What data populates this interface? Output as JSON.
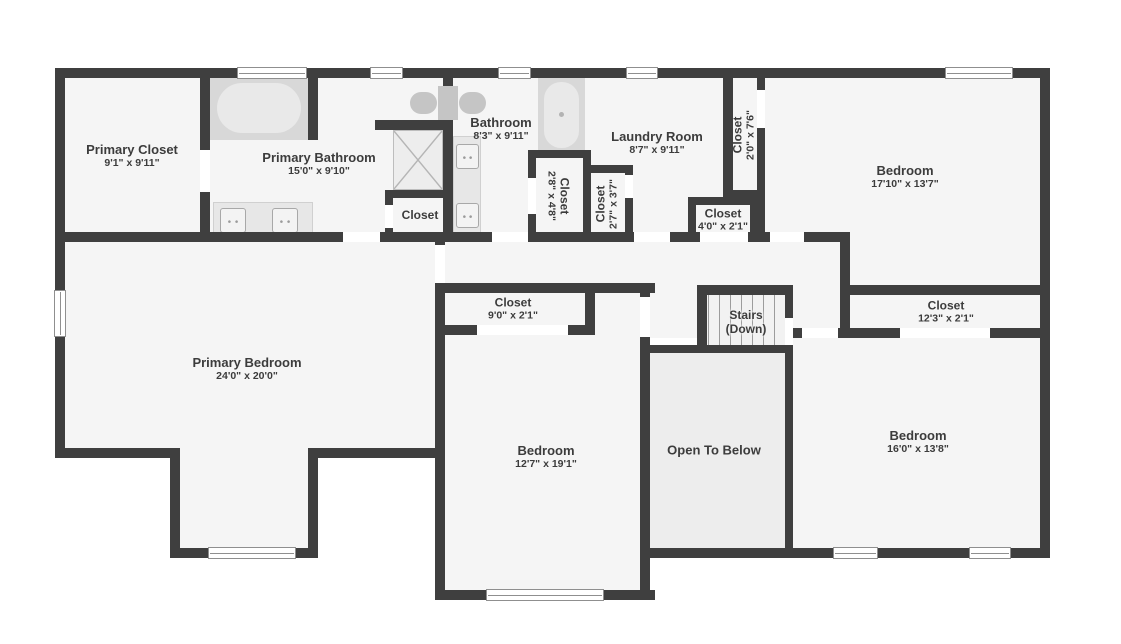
{
  "plan_title": "Second Floor Plan",
  "colors": {
    "wall": "#3f3f3f",
    "floor": "#f5f5f5",
    "open_to_below_floor": "#ededed",
    "label_text": "#3c3c3c",
    "background": "#ffffff"
  },
  "rooms": {
    "primary_closet": {
      "name": "Primary Closet",
      "dims": "9'1\" x 9'11\""
    },
    "primary_bathroom": {
      "name": "Primary Bathroom",
      "dims": "15'0\" x 9'10\""
    },
    "bathroom": {
      "name": "Bathroom",
      "dims": "8'3\" x 9'11\""
    },
    "laundry_room": {
      "name": "Laundry Room",
      "dims": "8'7\" x 9'11\""
    },
    "closet_top_right": {
      "name": "Closet",
      "dims": "2'0\" x 7'6\""
    },
    "closet_bath_left": {
      "name": "Closet",
      "dims": "2'8\" x 4'8\""
    },
    "closet_bath_right": {
      "name": "Closet",
      "dims": "2'7\" x 3'7\""
    },
    "closet_hall": {
      "name": "Closet",
      "dims": "4'0\" x 2'1\""
    },
    "closet_primary_bath": {
      "name": "Closet"
    },
    "bedroom_top_right": {
      "name": "Bedroom",
      "dims": "17'10\" x 13'7\""
    },
    "primary_bedroom": {
      "name": "Primary Bedroom",
      "dims": "24'0\" x 20'0\""
    },
    "closet_bedroom_mid": {
      "name": "Closet",
      "dims": "9'0\" x 2'1\""
    },
    "stairs": {
      "line1": "Stairs",
      "line2": "(Down)"
    },
    "closet_bedroom_right": {
      "name": "Closet",
      "dims": "12'3\" x 2'1\""
    },
    "bedroom_mid": {
      "name": "Bedroom",
      "dims": "12'7\" x 19'1\""
    },
    "open_to_below": {
      "name": "Open To Below"
    },
    "bedroom_bottom_right": {
      "name": "Bedroom",
      "dims": "16'0\" x 13'8\""
    }
  }
}
